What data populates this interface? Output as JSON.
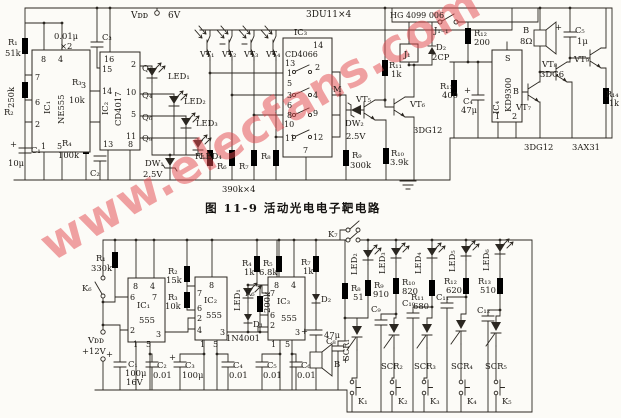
{
  "title": "图 11-9  活动光电电子靶电路",
  "watermark": "www.elecfans.com",
  "colors": {
    "ink": "#2b2721",
    "paper": "#fcfbf7",
    "watermark": "#e4484d"
  },
  "labels": [
    {
      "t": "Vᴅᴅ",
      "x": 131,
      "y": 18,
      "fs": 9
    },
    {
      "t": "6V",
      "x": 168,
      "y": 18,
      "fs": 9
    },
    {
      "t": "3DU11×4",
      "x": 306,
      "y": 17,
      "fs": 9
    },
    {
      "t": "HG 4099 006",
      "x": 390,
      "y": 18,
      "fs": 8
    },
    {
      "t": "J₁₋₁",
      "x": 434,
      "y": 33
    },
    {
      "t": "R₁",
      "x": 8,
      "y": 45
    },
    {
      "t": "51k",
      "x": 5,
      "y": 56
    },
    {
      "t": "250k",
      "x": 14,
      "y": 108,
      "r": -90
    },
    {
      "t": "R₂",
      "x": 4,
      "y": 115
    },
    {
      "t": "+",
      "x": 10,
      "y": 147
    },
    {
      "t": "C₁",
      "x": 31,
      "y": 153
    },
    {
      "t": "10μ",
      "x": 8,
      "y": 166
    },
    {
      "t": "0.01μ",
      "x": 54,
      "y": 39
    },
    {
      "t": "×2",
      "x": 60,
      "y": 49
    },
    {
      "t": "C₃",
      "x": 102,
      "y": 40
    },
    {
      "t": "R₃",
      "x": 72,
      "y": 85
    },
    {
      "t": "10k",
      "x": 69,
      "y": 103
    },
    {
      "t": "R₄",
      "x": 62,
      "y": 146
    },
    {
      "t": "100k",
      "x": 58,
      "y": 158
    },
    {
      "t": "C₂",
      "x": 90,
      "y": 176
    },
    {
      "t": "8",
      "x": 41,
      "y": 62,
      "fs": 8
    },
    {
      "t": "4",
      "x": 58,
      "y": 62,
      "fs": 8
    },
    {
      "t": "7",
      "x": 35,
      "y": 80,
      "fs": 8
    },
    {
      "t": "6",
      "x": 35,
      "y": 105,
      "fs": 8
    },
    {
      "t": "2",
      "x": 35,
      "y": 127,
      "fs": 8
    },
    {
      "t": "1",
      "x": 41,
      "y": 149,
      "fs": 8
    },
    {
      "t": "5",
      "x": 57,
      "y": 149,
      "fs": 8
    },
    {
      "t": "3",
      "x": 81,
      "y": 88,
      "fs": 8
    },
    {
      "t": "IC₁",
      "x": 50,
      "y": 114,
      "r": -90
    },
    {
      "t": "NE555",
      "x": 64,
      "y": 124,
      "r": -90
    },
    {
      "t": "16",
      "x": 104,
      "y": 62,
      "fs": 8
    },
    {
      "t": "15",
      "x": 102,
      "y": 72,
      "fs": 8
    },
    {
      "t": "14",
      "x": 102,
      "y": 94,
      "fs": 8
    },
    {
      "t": "13",
      "x": 103,
      "y": 147,
      "fs": 8
    },
    {
      "t": "2",
      "x": 131,
      "y": 67,
      "fs": 8
    },
    {
      "t": "10",
      "x": 126,
      "y": 95,
      "fs": 8
    },
    {
      "t": "5",
      "x": 131,
      "y": 117,
      "fs": 8
    },
    {
      "t": "11",
      "x": 126,
      "y": 139,
      "fs": 8
    },
    {
      "t": "8",
      "x": 128,
      "y": 147,
      "fs": 8
    },
    {
      "t": "IC₂",
      "x": 108,
      "y": 115,
      "r": -90
    },
    {
      "t": "CD4017",
      "x": 121,
      "y": 126,
      "r": -90
    },
    {
      "t": "Q₁",
      "x": 142,
      "y": 71
    },
    {
      "t": "Q₄",
      "x": 142,
      "y": 98
    },
    {
      "t": "Q₆",
      "x": 142,
      "y": 120
    },
    {
      "t": "Q₉",
      "x": 142,
      "y": 141
    },
    {
      "t": "LED₁",
      "x": 168,
      "y": 79
    },
    {
      "t": "LED₂",
      "x": 184,
      "y": 104
    },
    {
      "t": "LED₃",
      "x": 196,
      "y": 126
    },
    {
      "t": "LED₄",
      "x": 200,
      "y": 159
    },
    {
      "t": "DW₁",
      "x": 145,
      "y": 166
    },
    {
      "t": "2.5V",
      "x": 143,
      "y": 177
    },
    {
      "t": "VT₁",
      "x": 200,
      "y": 57,
      "fs": 8
    },
    {
      "t": "VT₂",
      "x": 222,
      "y": 57,
      "fs": 8
    },
    {
      "t": "VT₃",
      "x": 244,
      "y": 57,
      "fs": 8
    },
    {
      "t": "VT₄",
      "x": 266,
      "y": 57,
      "fs": 8
    },
    {
      "t": "R₅",
      "x": 195,
      "y": 159
    },
    {
      "t": "R₆",
      "x": 217,
      "y": 169
    },
    {
      "t": "R₇",
      "x": 239,
      "y": 169
    },
    {
      "t": "R₈",
      "x": 261,
      "y": 159
    },
    {
      "t": "390k×4",
      "x": 222,
      "y": 192
    },
    {
      "t": "IC₃",
      "x": 294,
      "y": 35
    },
    {
      "t": "CD4066",
      "x": 285,
      "y": 57,
      "fs": 8
    },
    {
      "t": "14",
      "x": 313,
      "y": 48,
      "fs": 8
    },
    {
      "t": "13",
      "x": 285,
      "y": 66,
      "fs": 8
    },
    {
      "t": "1",
      "x": 287,
      "y": 76,
      "fs": 8
    },
    {
      "t": "2",
      "x": 315,
      "y": 70,
      "fs": 8
    },
    {
      "t": "5",
      "x": 287,
      "y": 86,
      "fs": 8
    },
    {
      "t": "3",
      "x": 287,
      "y": 98,
      "fs": 8
    },
    {
      "t": "4",
      "x": 313,
      "y": 98,
      "fs": 8
    },
    {
      "t": "6",
      "x": 287,
      "y": 108,
      "fs": 8
    },
    {
      "t": "8",
      "x": 287,
      "y": 118,
      "fs": 8
    },
    {
      "t": "9",
      "x": 313,
      "y": 116,
      "fs": 8
    },
    {
      "t": "10",
      "x": 284,
      "y": 127,
      "fs": 8
    },
    {
      "t": "11",
      "x": 285,
      "y": 141,
      "fs": 8
    },
    {
      "t": "12",
      "x": 313,
      "y": 140,
      "fs": 8
    },
    {
      "t": "7",
      "x": 303,
      "y": 153,
      "fs": 8
    },
    {
      "t": "M",
      "x": 333,
      "y": 92
    },
    {
      "t": "VT₅",
      "x": 356,
      "y": 102
    },
    {
      "t": "DW₂",
      "x": 345,
      "y": 126
    },
    {
      "t": "2.5V",
      "x": 346,
      "y": 139
    },
    {
      "t": "R₉",
      "x": 352,
      "y": 158
    },
    {
      "t": "300k",
      "x": 350,
      "y": 168
    },
    {
      "t": "R₁₁",
      "x": 389,
      "y": 68
    },
    {
      "t": "1k",
      "x": 391,
      "y": 77
    },
    {
      "t": "VT₆",
      "x": 410,
      "y": 107
    },
    {
      "t": "3DG12",
      "x": 413,
      "y": 133
    },
    {
      "t": "R₁₀",
      "x": 391,
      "y": 156
    },
    {
      "t": "3.9k",
      "x": 390,
      "y": 165
    },
    {
      "t": "J₁",
      "x": 404,
      "y": 57,
      "fs": 8
    },
    {
      "t": "D₂",
      "x": 436,
      "y": 50
    },
    {
      "t": "2CP",
      "x": 432,
      "y": 60
    },
    {
      "t": "R₁₂",
      "x": 474,
      "y": 36
    },
    {
      "t": "200",
      "x": 474,
      "y": 45
    },
    {
      "t": "R₁₃",
      "x": 440,
      "y": 89
    },
    {
      "t": "400",
      "x": 442,
      "y": 98
    },
    {
      "t": "+",
      "x": 464,
      "y": 93
    },
    {
      "t": "C₄",
      "x": 463,
      "y": 104
    },
    {
      "t": "47μ",
      "x": 461,
      "y": 113
    },
    {
      "t": "S",
      "x": 505,
      "y": 61,
      "fs": 8
    },
    {
      "t": "B",
      "x": 513,
      "y": 94,
      "fs": 8
    },
    {
      "t": "KD9300",
      "x": 511,
      "y": 112,
      "r": -90
    },
    {
      "t": "IC₄",
      "x": 499,
      "y": 114,
      "r": -90
    },
    {
      "t": "1",
      "x": 495,
      "y": 119,
      "fs": 8
    },
    {
      "t": "2",
      "x": 512,
      "y": 119,
      "fs": 8
    },
    {
      "t": "B",
      "x": 523,
      "y": 33
    },
    {
      "t": "8Ω",
      "x": 520,
      "y": 44
    },
    {
      "t": "+",
      "x": 555,
      "y": 30
    },
    {
      "t": "C₅",
      "x": 575,
      "y": 33
    },
    {
      "t": "1μ",
      "x": 577,
      "y": 44
    },
    {
      "t": "VT₇",
      "x": 516,
      "y": 110
    },
    {
      "t": "VT₈",
      "x": 542,
      "y": 67
    },
    {
      "t": "3DG6",
      "x": 540,
      "y": 77
    },
    {
      "t": "VT₉",
      "x": 574,
      "y": 62
    },
    {
      "t": "R₁₄",
      "x": 606,
      "y": 97,
      "fs": 8
    },
    {
      "t": "1k",
      "x": 609,
      "y": 106,
      "fs": 8
    },
    {
      "t": "3DG12",
      "x": 524,
      "y": 150
    },
    {
      "t": "3AX31",
      "x": 572,
      "y": 150
    },
    {
      "t": "R₁",
      "x": 96,
      "y": 261
    },
    {
      "t": "330k",
      "x": 91,
      "y": 271
    },
    {
      "t": "K₆",
      "x": 82,
      "y": 291
    },
    {
      "t": "Vᴅᴅ",
      "x": 88,
      "y": 343
    },
    {
      "t": "+12V",
      "x": 82,
      "y": 354
    },
    {
      "t": "+",
      "x": 106,
      "y": 357
    },
    {
      "t": "C₁",
      "x": 128,
      "y": 367
    },
    {
      "t": "100μ",
      "x": 125,
      "y": 376
    },
    {
      "t": "16V",
      "x": 126,
      "y": 385
    },
    {
      "t": "8",
      "x": 133,
      "y": 289,
      "fs": 8
    },
    {
      "t": "4",
      "x": 150,
      "y": 289,
      "fs": 8
    },
    {
      "t": "6",
      "x": 130,
      "y": 300,
      "fs": 8
    },
    {
      "t": "7",
      "x": 152,
      "y": 300,
      "fs": 8
    },
    {
      "t": "IC₁",
      "x": 137,
      "y": 308
    },
    {
      "t": "555",
      "x": 139,
      "y": 323
    },
    {
      "t": "2",
      "x": 130,
      "y": 333,
      "fs": 8
    },
    {
      "t": "1",
      "x": 133,
      "y": 347,
      "fs": 8
    },
    {
      "t": "5",
      "x": 146,
      "y": 347,
      "fs": 8
    },
    {
      "t": "3",
      "x": 156,
      "y": 337,
      "fs": 8
    },
    {
      "t": "R₂",
      "x": 168,
      "y": 274
    },
    {
      "t": "15k",
      "x": 166,
      "y": 283
    },
    {
      "t": "R₃",
      "x": 168,
      "y": 300
    },
    {
      "t": "10k",
      "x": 165,
      "y": 309
    },
    {
      "t": "8",
      "x": 209,
      "y": 288,
      "fs": 8
    },
    {
      "t": "7",
      "x": 197,
      "y": 296,
      "fs": 8
    },
    {
      "t": "IC₂",
      "x": 204,
      "y": 303
    },
    {
      "t": "6",
      "x": 197,
      "y": 311,
      "fs": 8
    },
    {
      "t": "555",
      "x": 206,
      "y": 318
    },
    {
      "t": "2",
      "x": 197,
      "y": 321,
      "fs": 8
    },
    {
      "t": "4",
      "x": 197,
      "y": 333,
      "fs": 8
    },
    {
      "t": "1",
      "x": 200,
      "y": 347,
      "fs": 8
    },
    {
      "t": "5",
      "x": 213,
      "y": 347,
      "fs": 8
    },
    {
      "t": "3",
      "x": 220,
      "y": 335,
      "fs": 8
    },
    {
      "t": "R₄",
      "x": 242,
      "y": 266
    },
    {
      "t": "1k",
      "x": 244,
      "y": 275
    },
    {
      "t": "R₅",
      "x": 263,
      "y": 266
    },
    {
      "t": "6.8k",
      "x": 259,
      "y": 275
    },
    {
      "t": "LED₁",
      "x": 240,
      "y": 311,
      "r": -90
    },
    {
      "t": "R₆",
      "x": 245,
      "y": 296
    },
    {
      "t": "200k",
      "x": 270,
      "y": 313,
      "r": -90
    },
    {
      "t": "D₁",
      "x": 253,
      "y": 327
    },
    {
      "t": "1N4001",
      "x": 226,
      "y": 341
    },
    {
      "t": "8",
      "x": 274,
      "y": 288,
      "fs": 8
    },
    {
      "t": "4",
      "x": 291,
      "y": 288,
      "fs": 8
    },
    {
      "t": "7",
      "x": 270,
      "y": 296,
      "fs": 8
    },
    {
      "t": "IC₃",
      "x": 277,
      "y": 304
    },
    {
      "t": "6",
      "x": 270,
      "y": 318,
      "fs": 8
    },
    {
      "t": "555",
      "x": 281,
      "y": 321
    },
    {
      "t": "2",
      "x": 270,
      "y": 328,
      "fs": 8
    },
    {
      "t": "3",
      "x": 295,
      "y": 335,
      "fs": 8
    },
    {
      "t": "1",
      "x": 271,
      "y": 347,
      "fs": 8
    },
    {
      "t": "5",
      "x": 285,
      "y": 347,
      "fs": 8
    },
    {
      "t": "R₇",
      "x": 301,
      "y": 265
    },
    {
      "t": "1k",
      "x": 303,
      "y": 274
    },
    {
      "t": "D₂",
      "x": 321,
      "y": 302
    },
    {
      "t": "+",
      "x": 301,
      "y": 334
    },
    {
      "t": "47μ",
      "x": 324,
      "y": 338
    },
    {
      "t": "B",
      "x": 334,
      "y": 367
    },
    {
      "t": "C₂",
      "x": 157,
      "y": 368
    },
    {
      "t": "0.01",
      "x": 153,
      "y": 378
    },
    {
      "t": "+",
      "x": 169,
      "y": 360
    },
    {
      "t": "C₃",
      "x": 185,
      "y": 368
    },
    {
      "t": "100μ",
      "x": 182,
      "y": 378
    },
    {
      "t": "C₄",
      "x": 233,
      "y": 368
    },
    {
      "t": "0.01",
      "x": 229,
      "y": 378
    },
    {
      "t": "C₅",
      "x": 267,
      "y": 368
    },
    {
      "t": "0.01",
      "x": 263,
      "y": 378
    },
    {
      "t": "C₆",
      "x": 301,
      "y": 368
    },
    {
      "t": "0.01",
      "x": 297,
      "y": 378
    },
    {
      "t": "K₇",
      "x": 328,
      "y": 237
    },
    {
      "t": "LED₂",
      "x": 357,
      "y": 275,
      "r": -90
    },
    {
      "t": "R₈",
      "x": 351,
      "y": 291
    },
    {
      "t": "51",
      "x": 353,
      "y": 300
    },
    {
      "t": "LED₃",
      "x": 385,
      "y": 274,
      "r": -90
    },
    {
      "t": "R₉",
      "x": 374,
      "y": 288
    },
    {
      "t": "910",
      "x": 373,
      "y": 297
    },
    {
      "t": "LED₄",
      "x": 421,
      "y": 274,
      "r": -90
    },
    {
      "t": "R₁₀",
      "x": 402,
      "y": 285
    },
    {
      "t": "820",
      "x": 402,
      "y": 294
    },
    {
      "t": "R₁₁",
      "x": 411,
      "y": 300
    },
    {
      "t": "680",
      "x": 413,
      "y": 309
    },
    {
      "t": "LED₅",
      "x": 455,
      "y": 272,
      "r": -90
    },
    {
      "t": "R₁₂",
      "x": 444,
      "y": 284
    },
    {
      "t": "620",
      "x": 446,
      "y": 293
    },
    {
      "t": "LED₆",
      "x": 489,
      "y": 271,
      "r": -90
    },
    {
      "t": "R₁₃",
      "x": 478,
      "y": 284
    },
    {
      "t": "510",
      "x": 480,
      "y": 293
    },
    {
      "t": "C₈",
      "x": 326,
      "y": 344
    },
    {
      "t": "+",
      "x": 342,
      "y": 363
    },
    {
      "t": "C₉",
      "x": 371,
      "y": 312
    },
    {
      "t": "C₁₀",
      "x": 402,
      "y": 306
    },
    {
      "t": "C₁₁",
      "x": 436,
      "y": 300
    },
    {
      "t": "C₁₂",
      "x": 477,
      "y": 313
    },
    {
      "t": "SCR₁",
      "x": 349,
      "y": 361,
      "r": -90
    },
    {
      "t": "SCR₂",
      "x": 381,
      "y": 369
    },
    {
      "t": "SCR₃",
      "x": 414,
      "y": 369
    },
    {
      "t": "SCR₄",
      "x": 451,
      "y": 369
    },
    {
      "t": "SCR₅",
      "x": 485,
      "y": 369
    },
    {
      "t": "K₁",
      "x": 358,
      "y": 404
    },
    {
      "t": "K₂",
      "x": 398,
      "y": 404
    },
    {
      "t": "K₃",
      "x": 430,
      "y": 404
    },
    {
      "t": "K₄",
      "x": 467,
      "y": 404
    },
    {
      "t": "K₅",
      "x": 502,
      "y": 404
    }
  ]
}
